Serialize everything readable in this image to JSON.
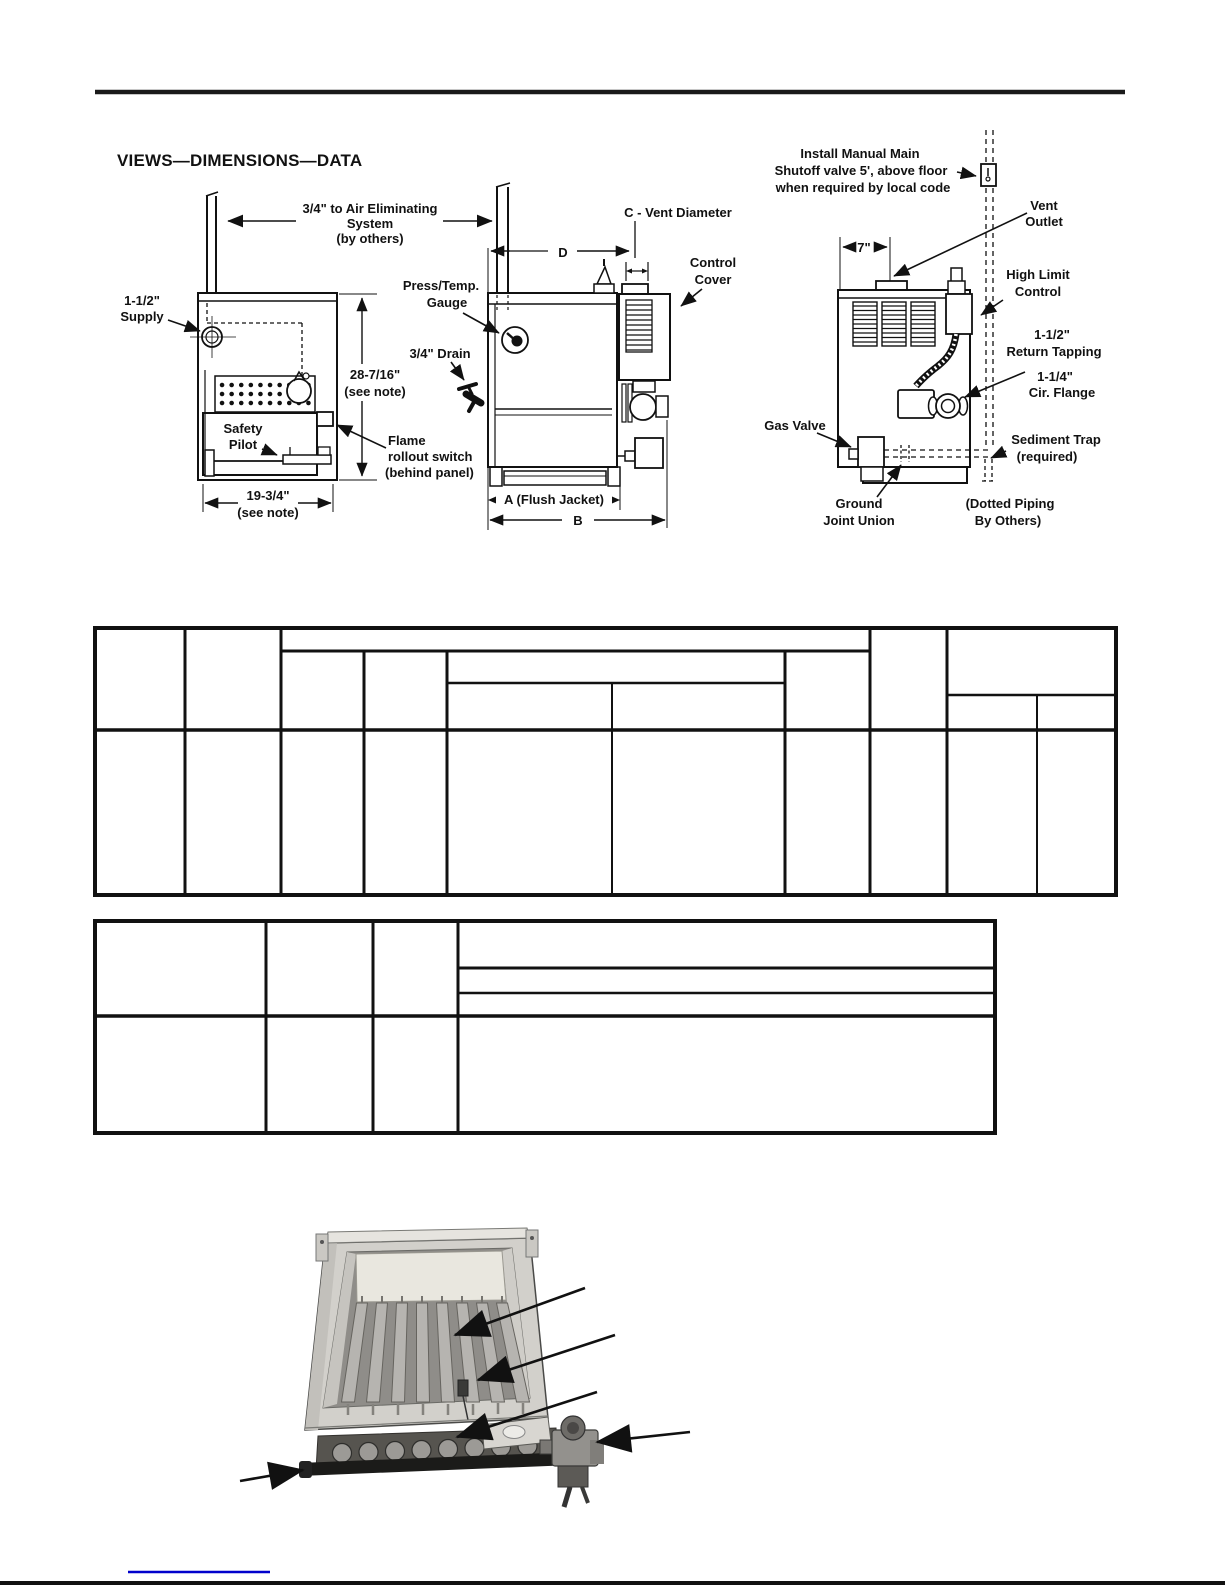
{
  "page": {
    "heading": "VIEWS—DIMENSIONS—DATA"
  },
  "colors": {
    "ink": "#111111",
    "link_blue": "#0000cc"
  },
  "front_view": {
    "air1": "3/4\" to Air Eliminating",
    "air2": "System",
    "air3": "(by others)",
    "supply1": "1-1/2\"",
    "supply2": "Supply",
    "height1": "28-7/16\"",
    "height2": "(see note)",
    "pilot1": "Safety",
    "pilot2": "Pilot",
    "rollout1": "Flame",
    "rollout2": "rollout switch",
    "rollout3": "(behind panel)",
    "width1": "19-3/4\"",
    "width2": "(see note)"
  },
  "side_view": {
    "gauge1": "Press/Temp.",
    "gauge2": "Gauge",
    "drain": "3/4\" Drain",
    "vent_c": "C - Vent Diameter",
    "dim_d": "D",
    "cover1": "Control",
    "cover2": "Cover",
    "dim_a": "A (Flush Jacket)",
    "dim_b": "B"
  },
  "rear_view": {
    "shutoff1": "Install Manual Main",
    "shutoff2": "Shutoff valve 5', above floor",
    "shutoff3": "when required by local code",
    "vent1": "Vent",
    "vent2": "Outlet",
    "dim7": "7\"",
    "highlimit1": "High Limit",
    "highlimit2": "Control",
    "return1": "1-1/2\"",
    "return2": "Return Tapping",
    "flange1": "1-1/4\"",
    "flange2": "Cir. Flange",
    "gasvalve": "Gas Valve",
    "sediment1": "Sediment Trap",
    "sediment2": "(required)",
    "union1": "Ground",
    "union2": "Joint Union",
    "dotted1": "(Dotted Piping",
    "dotted2": "By Others)"
  }
}
